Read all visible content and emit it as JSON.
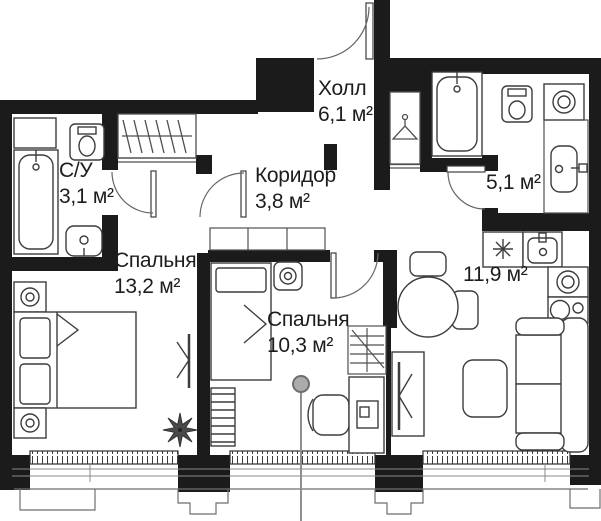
{
  "title": "Floor plan",
  "rooms": [
    {
      "id": "wc",
      "name": "С/У",
      "area": "3,1 м²"
    },
    {
      "id": "hall",
      "name": "Холл",
      "area": "6,1 м²"
    },
    {
      "id": "corridor",
      "name": "Коридор",
      "area": "3,8 м²"
    },
    {
      "id": "bathroom",
      "name": "",
      "area": "5,1 м²"
    },
    {
      "id": "bedroom-1",
      "name": "Спальня",
      "area": "13,2 м²"
    },
    {
      "id": "bedroom-2",
      "name": "Спальня",
      "area": "10,3 м²"
    },
    {
      "id": "kitchen-living",
      "name": "",
      "area": "11,9 м²"
    }
  ],
  "colors": {
    "wall": "#1b1b1b",
    "fixture_line": "#3d3d3d",
    "thin_line": "#8a8a8a",
    "plant": "#4a4a4a",
    "pin": "#ababab"
  },
  "icons": [
    "entrance-door-icon",
    "hanger-icon",
    "bathtub-icon",
    "toilet-icon",
    "sink-icon",
    "washing-machine-icon",
    "stove-icon",
    "oven-icon",
    "cooktop-icon",
    "double-bed-icon",
    "single-bed-icon",
    "nightstand-icon",
    "tv-icon",
    "plant-icon",
    "sofa-icon",
    "coffee-table-icon",
    "dining-table-icon",
    "chair-icon",
    "desk-icon",
    "ladder-icon",
    "wardrobe-icon",
    "window-icon",
    "location-pin-icon"
  ]
}
